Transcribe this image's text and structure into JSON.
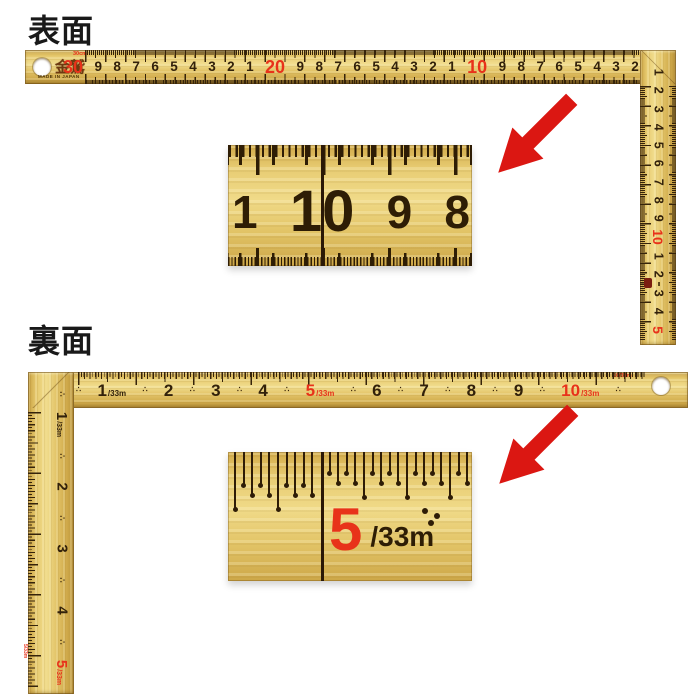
{
  "colors": {
    "background": "#ffffff",
    "brass": "#e6c96e",
    "tick_brown": "#35230a",
    "number_dark": "#32210a",
    "accent_red": "#e8321a",
    "arrow_red": "#db1712"
  },
  "glyphs": {
    "half_mark": "∴"
  },
  "front": {
    "label": "表面",
    "ruler": {
      "brand": "金鷲",
      "made_in": "MADE IN JAPAN",
      "scale_note": "30cm",
      "horizontal_numbers": [
        {
          "t": "30",
          "red": true
        },
        {
          "t": "9"
        },
        {
          "t": "8"
        },
        {
          "t": "7"
        },
        {
          "t": "6"
        },
        {
          "t": "5"
        },
        {
          "t": "4"
        },
        {
          "t": "3"
        },
        {
          "t": "2"
        },
        {
          "t": "1"
        },
        {
          "t": "20",
          "red": true
        },
        {
          "t": "9"
        },
        {
          "t": "8"
        },
        {
          "t": "7"
        },
        {
          "t": "6"
        },
        {
          "t": "5"
        },
        {
          "t": "4"
        },
        {
          "t": "3"
        },
        {
          "t": "2"
        },
        {
          "t": "1"
        },
        {
          "t": "10",
          "red": true
        },
        {
          "t": "9"
        },
        {
          "t": "8"
        },
        {
          "t": "7"
        },
        {
          "t": "6"
        },
        {
          "t": "5"
        },
        {
          "t": "4"
        },
        {
          "t": "3"
        },
        {
          "t": "2"
        },
        {
          "t": "1"
        }
      ],
      "vertical_numbers": [
        {
          "t": "1"
        },
        {
          "t": "2"
        },
        {
          "t": "3"
        },
        {
          "t": "4"
        },
        {
          "t": "5"
        },
        {
          "t": "6"
        },
        {
          "t": "7"
        },
        {
          "t": "8"
        },
        {
          "t": "9"
        },
        {
          "t": "10",
          "red": true
        },
        {
          "t": "1"
        },
        {
          "t": "2"
        },
        {
          "t": "3"
        },
        {
          "t": "4"
        },
        {
          "t": "5",
          "red": true
        }
      ]
    },
    "inset_numbers": [
      {
        "t": "1"
      },
      {
        "t": "10",
        "red": true
      },
      {
        "t": "9"
      },
      {
        "t": "8"
      }
    ]
  },
  "back": {
    "label": "裏面",
    "ruler": {
      "note_top_right": "16/33m",
      "note_bottom": "5/33m",
      "horizontal_items": [
        {
          "mark": true
        },
        {
          "t": "1",
          "suffix": "/33m"
        },
        {
          "mark": true
        },
        {
          "t": "2"
        },
        {
          "mark": true
        },
        {
          "t": "3"
        },
        {
          "mark": true
        },
        {
          "t": "4"
        },
        {
          "mark": true
        },
        {
          "t": "5",
          "suffix": "/33m",
          "red": true
        },
        {
          "mark": true
        },
        {
          "t": "6"
        },
        {
          "mark": true
        },
        {
          "t": "7"
        },
        {
          "mark": true
        },
        {
          "t": "8"
        },
        {
          "mark": true
        },
        {
          "t": "9"
        },
        {
          "mark": true
        },
        {
          "t": "10",
          "suffix": "/33m",
          "red": true
        },
        {
          "mark": true
        }
      ],
      "vertical_items": [
        {
          "mark": true
        },
        {
          "t": "1",
          "suffix": "/33m"
        },
        {
          "mark": true
        },
        {
          "t": "2"
        },
        {
          "mark": true
        },
        {
          "t": "3"
        },
        {
          "mark": true
        },
        {
          "t": "4"
        },
        {
          "mark": true
        },
        {
          "t": "5",
          "suffix": "/33m",
          "red": true
        }
      ]
    },
    "inset": {
      "number": "5",
      "suffix": "/33m"
    }
  }
}
